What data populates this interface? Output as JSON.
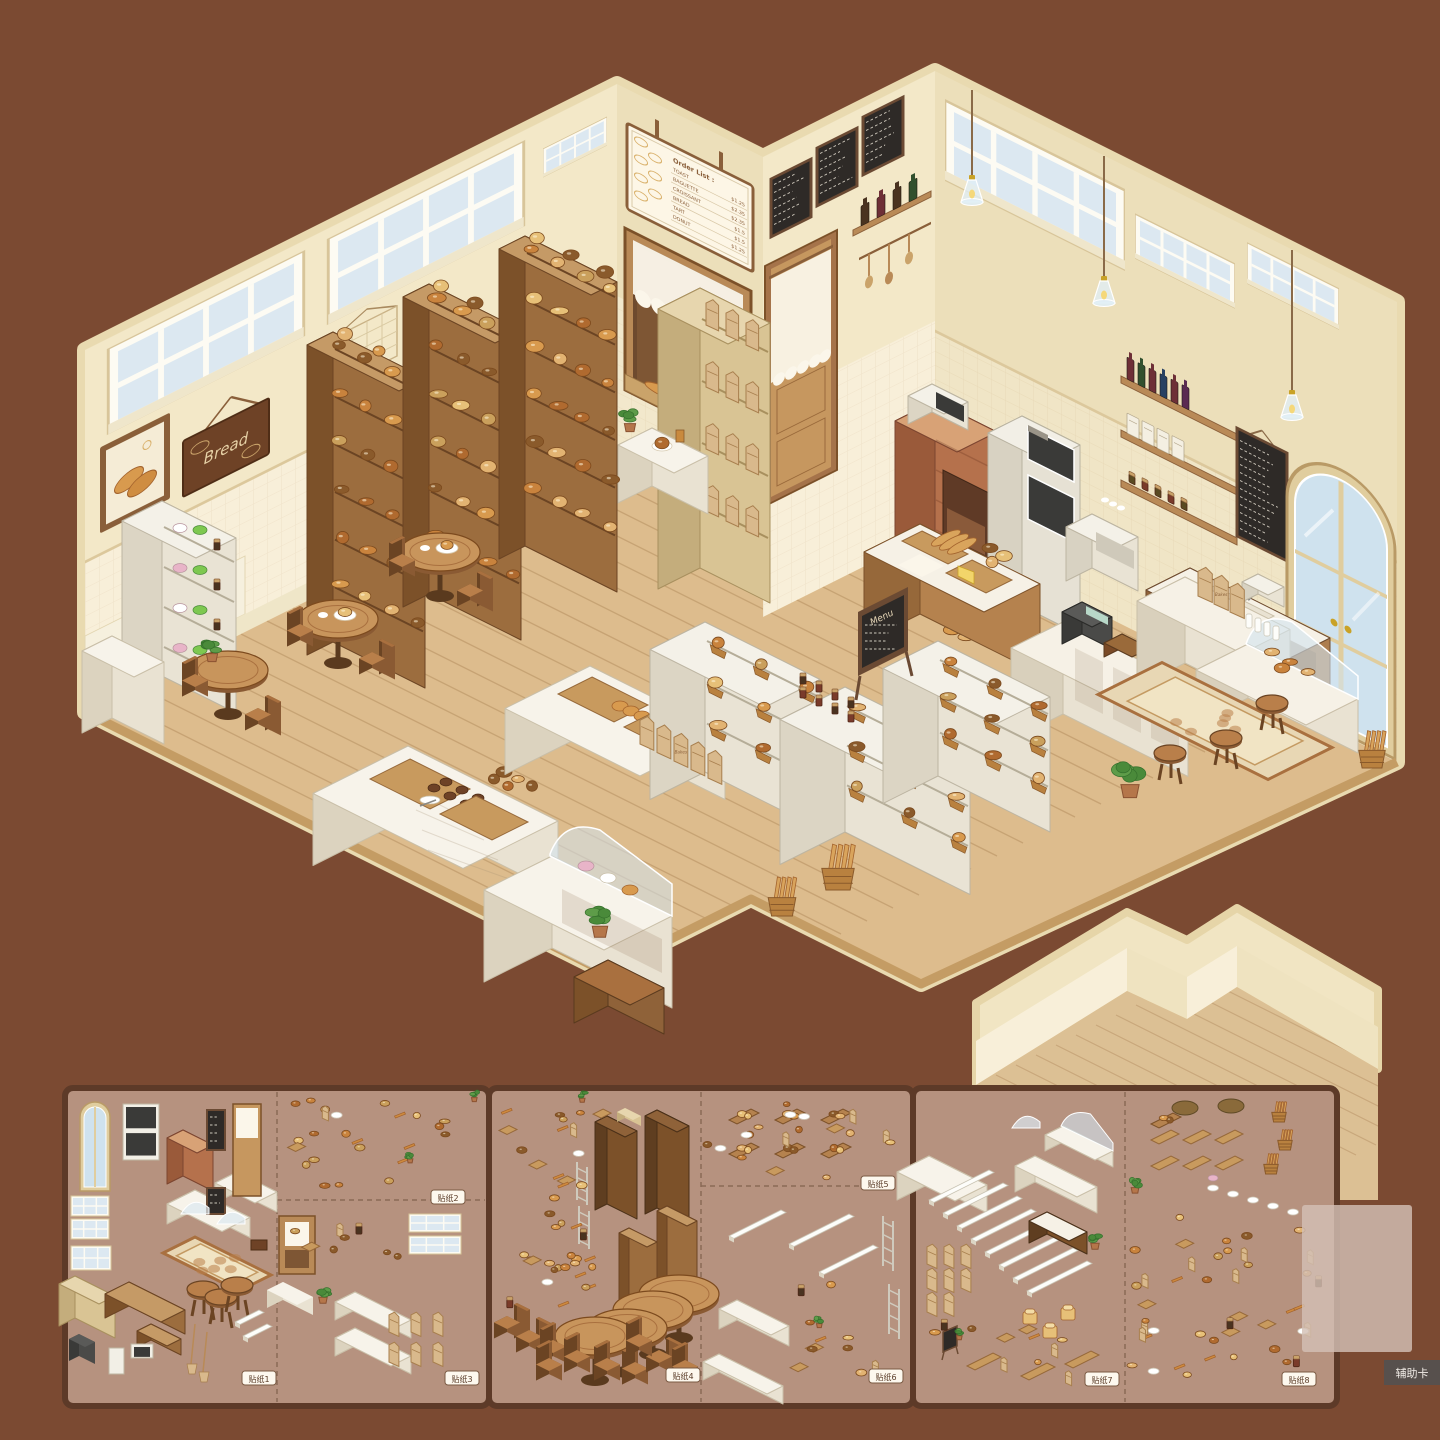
{
  "scene": {
    "order_list_sign": {
      "title": "Order List :",
      "items": [
        {
          "name": "TOAST",
          "price": "$1.25"
        },
        {
          "name": "BAGUETTE",
          "price": "$2.35"
        },
        {
          "name": "CROISSANT",
          "price": "$2.35"
        },
        {
          "name": "BREAD",
          "price": "$1.5"
        },
        {
          "name": "TART",
          "price": "$1.5"
        },
        {
          "name": "DONUT",
          "price": "$1.25"
        }
      ]
    },
    "bread_banner_label": "Bread",
    "menu_easel_label": "Menu",
    "paper_bag_label": "Bakes",
    "fixtures": [
      "bread-shelves",
      "bakers-rack",
      "cafe-tables",
      "display-tables",
      "curved-glass-counter",
      "bread-racks",
      "paper-bags",
      "jam-jars",
      "menu-easel",
      "brick-oven",
      "oven-stack",
      "espresso-machine",
      "coffee-counter",
      "pastry-case",
      "bar-stools",
      "floral-rug",
      "arched-door",
      "service-window",
      "curtain-door",
      "chalkboard-menus",
      "wall-windows",
      "pendant-lamps",
      "croissant-picture",
      "baguette-baskets",
      "potted-plants",
      "wine-shelf",
      "coffee-menu-board",
      "cash-register",
      "milk-bottles"
    ]
  },
  "sticker_sheets": {
    "tags": [
      "贴纸1",
      "贴纸2",
      "贴纸3",
      "贴纸4",
      "贴纸5",
      "贴纸6",
      "贴纸7",
      "贴纸8"
    ],
    "sheet1_contents": [
      "arched-door",
      "oven-stack",
      "brick-oven",
      "corner-counter",
      "chalkboards",
      "shop-door",
      "window-frames",
      "wood-counters",
      "cash-register",
      "toaster-oven",
      "stools",
      "rug",
      "brooms",
      "wine-bottles",
      "jam-jars",
      "paper-bags",
      "potted-plants",
      "service-window",
      "brick-counters",
      "glass-domes"
    ],
    "sheet2_contents": [
      "tall-wood-shelves",
      "ladder-racks",
      "cafe-tables",
      "wooden-chairs",
      "breads",
      "bread-crates",
      "white-tables",
      "white-counters",
      "metal-rack-frames"
    ],
    "sheet3_contents": [
      "display-counters",
      "curved-glass-cases",
      "shelf-planks",
      "paper-bags",
      "baguettes",
      "toast-loaves",
      "menu-easel",
      "wood-trays",
      "woven-baskets",
      "plates",
      "pastries",
      "potted-plants"
    ]
  },
  "aux_card": {
    "label": "辅助卡"
  },
  "palette": {
    "background": "#7B4A32",
    "sheet_bg": "#B6927F",
    "sheet_border": "#5D3A28",
    "wall": "#F3E8C8",
    "wall_shaded": "#ECDFBA",
    "wall_tile": "#F8EFD9",
    "wood_floor": "#DDBC8D",
    "wood_dark": "#8A5A33",
    "wood_mid": "#B07F4D",
    "bread": "#D89A4E",
    "bread_crust": "#A3632D",
    "white": "#FFFFFF",
    "glass_blue": "#D9E7F1",
    "chalkboard": "#2E2A27",
    "brick": "#BE7453",
    "leaf_green": "#5E9C49"
  }
}
